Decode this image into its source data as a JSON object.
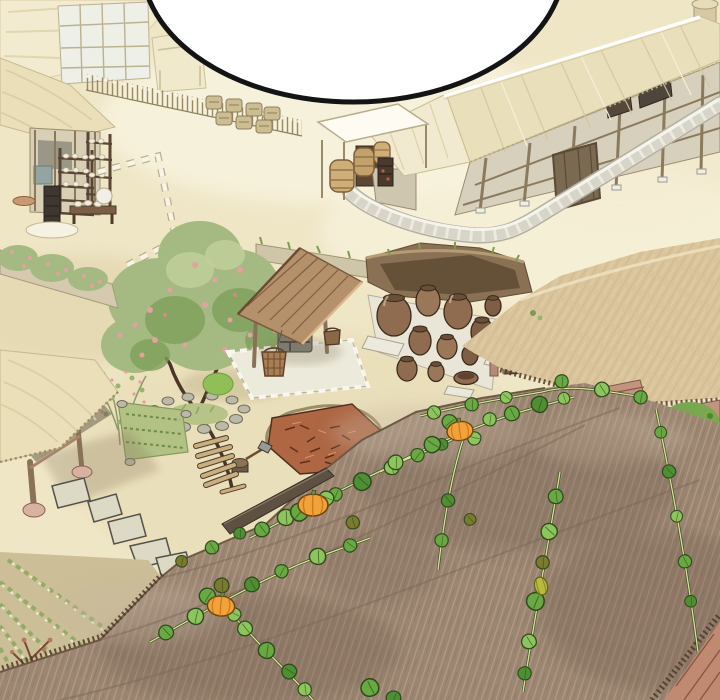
{
  "panel": {
    "type": "webtoon-illustration-panel",
    "setting": "Overhead view of a traditional Korean village courtyard",
    "speech_bubble": {
      "text": ""
    }
  },
  "palette": {
    "sand_base": "#efe6c6",
    "sand_light": "#f8f3de",
    "sand_shadow": "#ddcfa4",
    "thatch_pale": "#eadfb9",
    "thatch_edge": "#c6b98c",
    "roof_base": "#9c8672",
    "roof_light": "#c6b5a0",
    "roof_dark": "#6e5a48",
    "thatch_tan": "#d9c49c",
    "wood_dark": "#4e3c2c",
    "wood_mid": "#8a7258",
    "wall_beige": "#d7d0bc",
    "wall_pink": "#c2937e",
    "stone_light": "#eceade",
    "stone_mid": "#b3b0a0",
    "stone_dark": "#55504a",
    "jar_brown": "#8f6c50",
    "jar_dark": "#6a4f38",
    "foliage": "#a4ba82",
    "foliage_dark": "#7fa05c",
    "blossom": "#e5a0a0",
    "vine_green": "#68a943",
    "vine_light": "#8cc55c",
    "vine_deep": "#4f8f33",
    "vine_olive": "#7b7a2e",
    "vine_stem": "#dde29b",
    "vine_outline": "#2f4a1b",
    "pumpkin": "#f2a238",
    "pumpkin_rib": "#c97b1e",
    "firewood": "#b06a44",
    "field_green": "#94aa66",
    "field_ground": "#ccbe97",
    "well_roof": "#b5916b",
    "white": "#ffffff",
    "ink": "#141414",
    "outline": "#3a3028"
  },
  "scene": {
    "labels": {
      "panel": "Overhead illustrated view of a traditional Korean village",
      "speech_bubble": "Empty speech balloon cropped by panel top",
      "background_houses": "Sun-washed thatched houses and lattice walls",
      "brushwood_fence": "Brushwood fence with stacked kegs",
      "left_shop": "Open-front shop with pottery shelves and bench",
      "main_house": "Long thatched-roof house with stone boundary wall",
      "canopy_stall": "White canopy stall with wicker baskets and brazier",
      "mid_wall": "Low earthen wall with grass",
      "jar_terrace": "Earth bank and terrace of brown onggi jars",
      "well": "Covered well with stone shaft and wooden buckets",
      "tree": "Blossoming tree with stone-ringed mound",
      "left_gate": "Thatched gate structure",
      "garden": "Garden bed and flowering shrubs",
      "stepping_stones": "Stepping-stone path",
      "wood_yard": "Firewood pile, chopping stump and planks",
      "field": "Furrowed vegetable field with seedlings",
      "front_roof": "Large foreground thatched roof",
      "pumpkin_vines": "Pumpkin vines with orange pumpkins on the roof",
      "corner_eave": "Roof eave and pink wall at bottom-right corner"
    }
  }
}
